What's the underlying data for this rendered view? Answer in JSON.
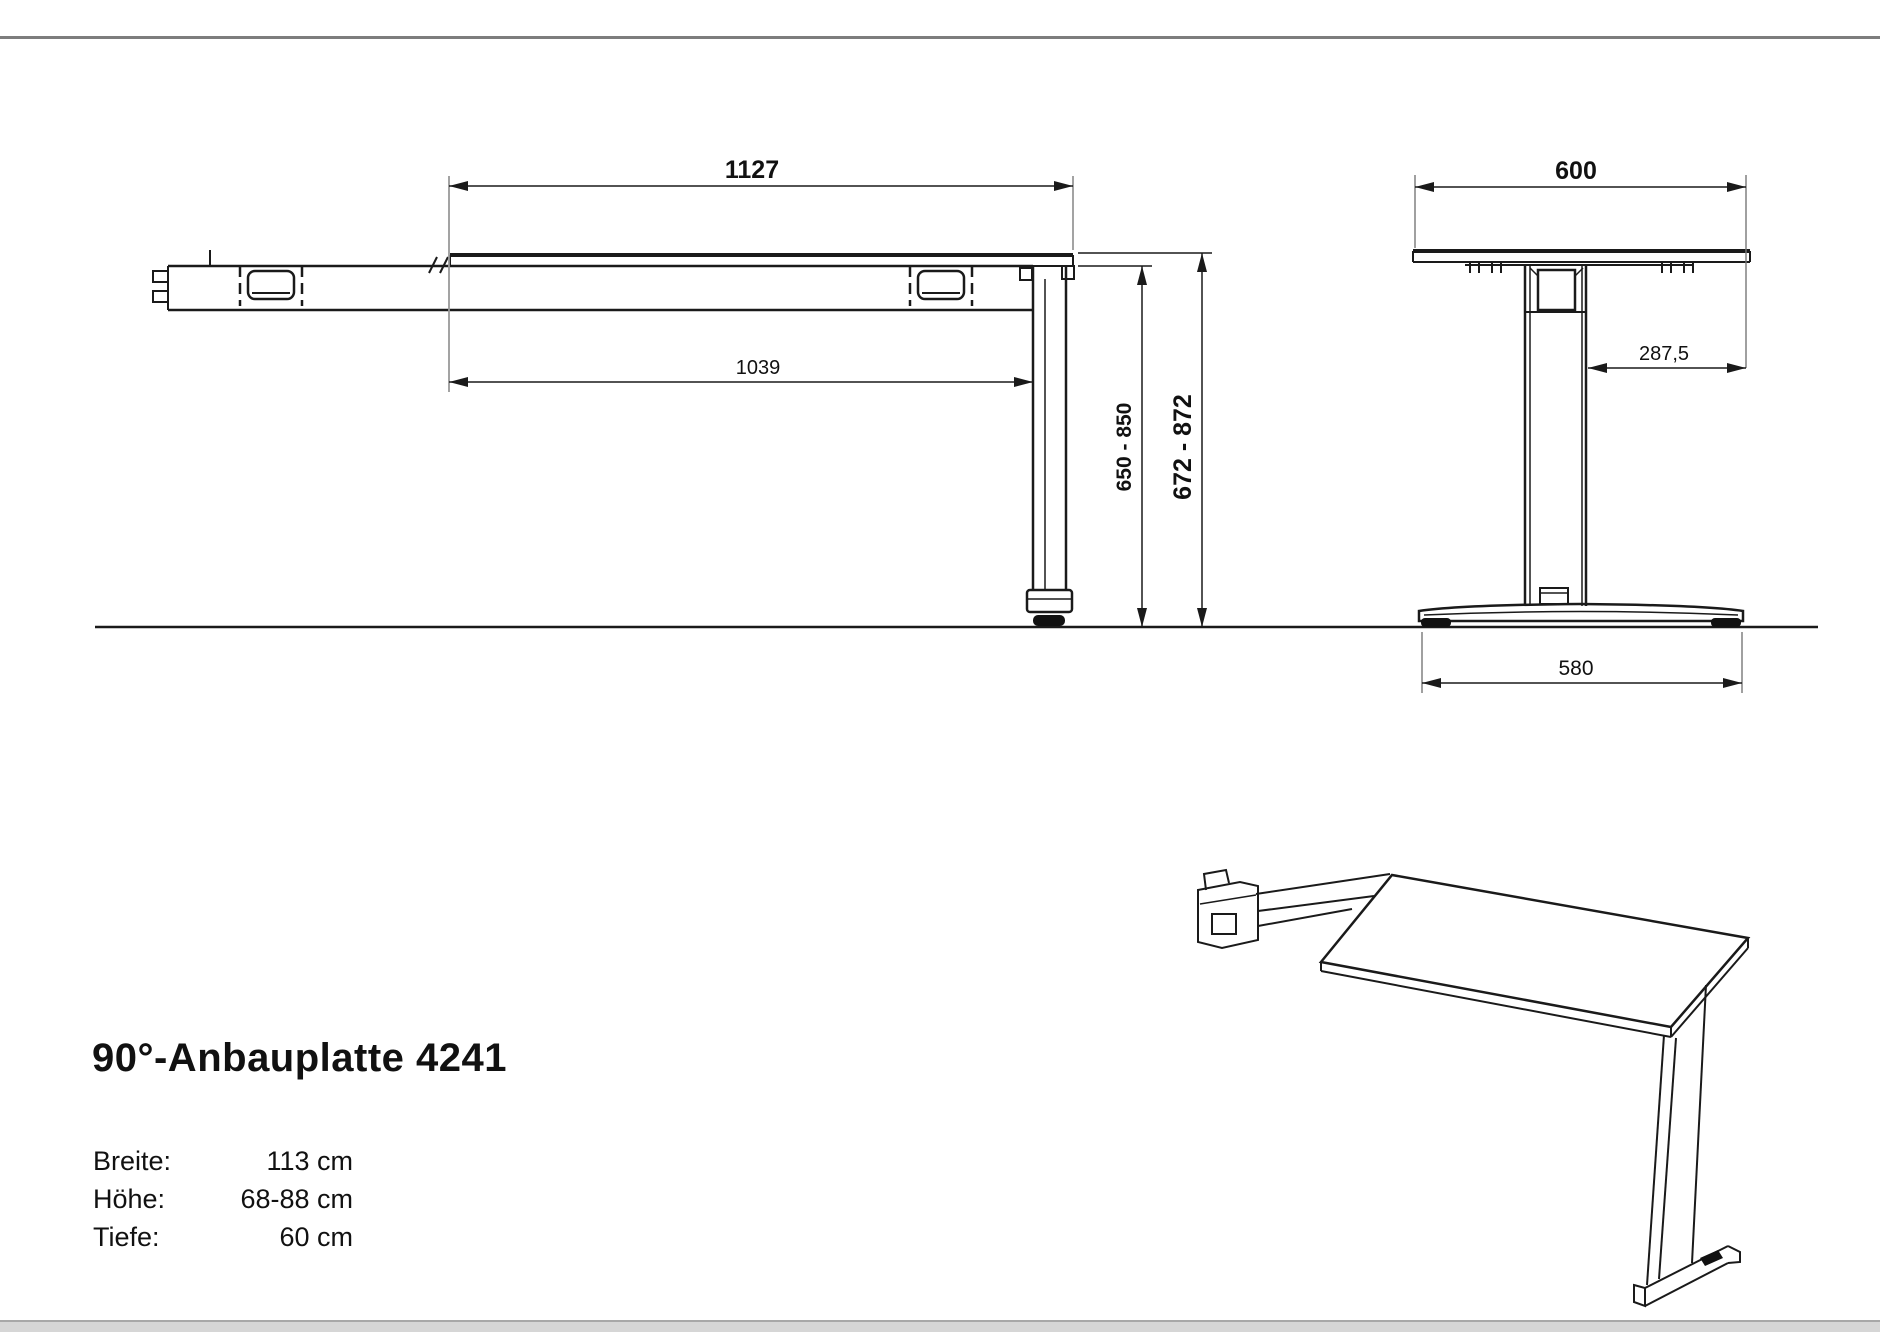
{
  "title": "90°-Anbauplatte 4241",
  "specs": [
    {
      "label": "Breite:",
      "value": "113 cm"
    },
    {
      "label": "Höhe:",
      "value": "68-88 cm"
    },
    {
      "label": "Tiefe:",
      "value": "60 cm"
    }
  ],
  "side_view": {
    "dim_top_width": "1127",
    "dim_inner_width": "1039",
    "dim_height_underside": "650 - 850",
    "dim_height_top": "672 - 872"
  },
  "front_view": {
    "dim_top_width": "600",
    "dim_column_to_edge": "287,5",
    "dim_foot_width": "580"
  },
  "colors": {
    "line": "#1a1a1a",
    "extension_line": "#999999",
    "border_top": "#7d7d7d",
    "border_bottom_line": "#a8a8a8",
    "border_bottom_strip": "#d6d6d6"
  }
}
